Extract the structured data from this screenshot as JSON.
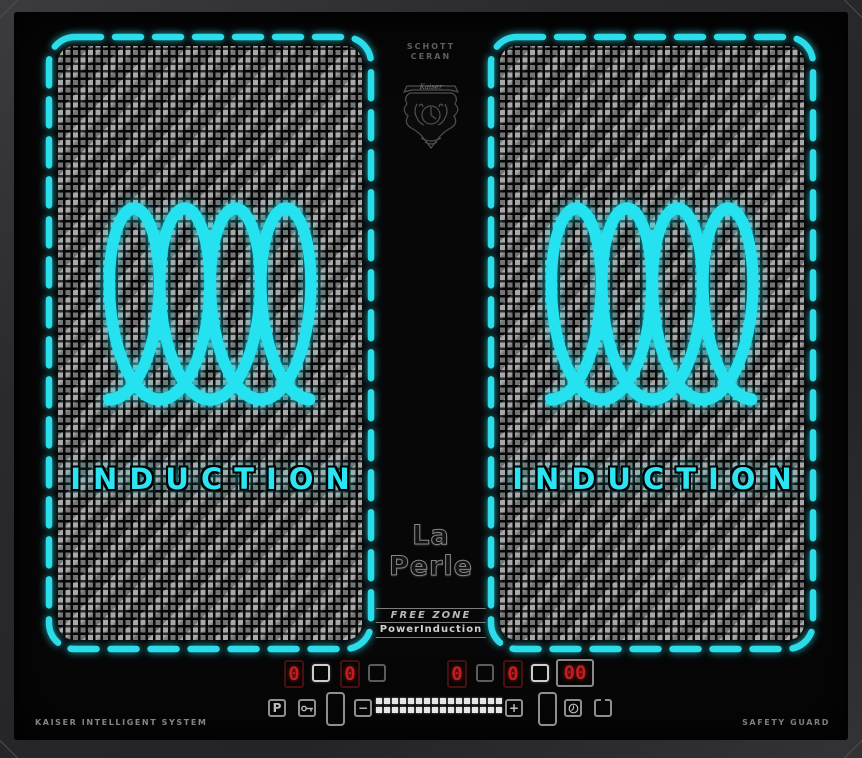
{
  "branding": {
    "glass_line1": "SCHOTT",
    "glass_line2": "CERAN",
    "emblem": "Kaiser",
    "model": "La Perle",
    "feature_top": "FREE ZONE",
    "feature_bottom": "PowerInduction",
    "footer_left": "KAISER INTELLIGENT SYSTEM",
    "footer_right": "SAFETY GUARD"
  },
  "zones": {
    "left": {
      "label": "INDUCTION"
    },
    "right": {
      "label": "INDUCTION"
    }
  },
  "controls": {
    "displays": {
      "left_front": "0",
      "left_rear": "0",
      "right_front": "0",
      "right_rear": "0",
      "timer": "00"
    },
    "buttons": {
      "boost": "P",
      "minus": "−",
      "plus": "+"
    },
    "icons": {
      "lock": "key-icon",
      "timer": "clock-icon",
      "power": "power-icon"
    }
  },
  "colors": {
    "accent_cyan": "#2bdce9",
    "display_red": "#c41d1d"
  }
}
